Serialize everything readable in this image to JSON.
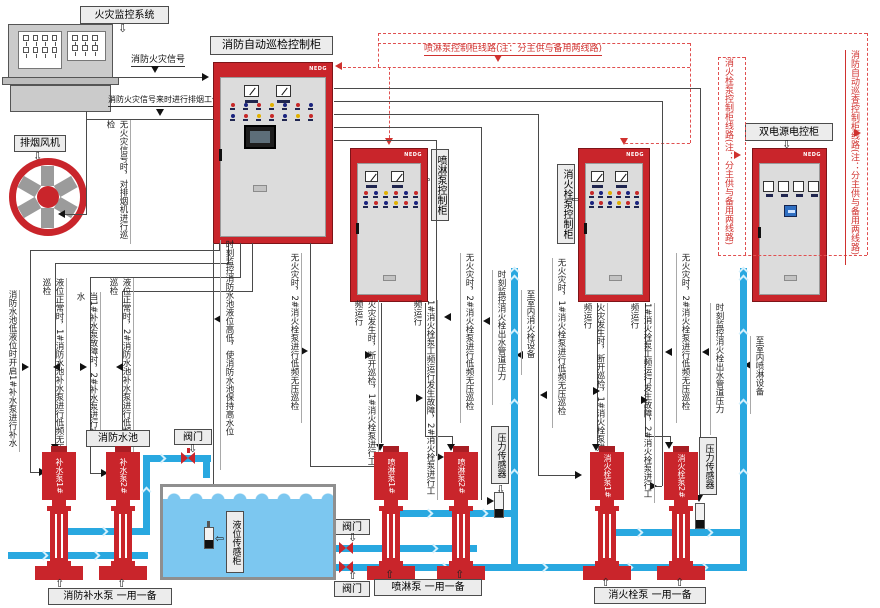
{
  "monitor": {
    "label": "火灾监控系统"
  },
  "fan": {
    "label": "排烟风机"
  },
  "signals": {
    "fire": "消防火灾信号",
    "smoke": "消防火灾信号来时进行排烟工作",
    "fan_note": "无火灾信号时，对排烟机进行巡检"
  },
  "cabinets": {
    "inspection": {
      "label": "消防自动巡检控制柜",
      "brand": "NEDG"
    },
    "spray": {
      "label": "喷淋泵控制柜",
      "brand": "NEDG"
    },
    "hydrant": {
      "label": "消火栓泵控制柜",
      "brand": "NEDG"
    },
    "dual_power": {
      "label": "双电源电控柜",
      "brand": "NEDG"
    }
  },
  "power_lines": {
    "spray": "喷淋泵控制柜线路(注：分主供与备用两线路)",
    "hydrant": "消火栓泵控制柜线路(注：分主供与备用两线路)",
    "inspection": "消防自动巡查控制柜线路(注：分主供与备用两线路)"
  },
  "tank": {
    "label": "消防水池",
    "level_sensor": "液位传感柜"
  },
  "valve_label": "阀门",
  "pressure_sensor_label": "压力传感器",
  "pumps": {
    "makeup1": "补水泵1#",
    "makeup2": "补水泵2#",
    "spray1": "喷淋泵1#",
    "spray2": "喷淋泵2#",
    "hydrant1": "消火栓泵1#",
    "hydrant2": "消火栓泵2#",
    "makeup_group": "消防补水泵  一用一备",
    "spray_group": "喷淋泵  一用一备",
    "hydrant_group": "消火栓泵  一用一备"
  },
  "annotations": {
    "a1": "消防水池低液位时开启1#补水泵进行补水",
    "a2": "液位正常时，1#消防水池补水泵进行低频无压巡检",
    "a3": "当1#补水泵故障时，2#补水泵进行补水",
    "a4": "液位正常时，2#消防水池补水泵进行低频无压巡检",
    "a5": "时刻监控消防水池液位高低，使消防水池保持高水位",
    "a6": "无火灾时，2#消火栓泵进行低频无压巡检",
    "a7": "火灾发生时，断开巡检，1#消火栓泵进行工频运行",
    "a8": "1#消火栓泵工频运行发生故障，2#消火栓泵进行工频运行",
    "a9": "无火灾时，2#消火栓泵进行低频无压巡检",
    "a10": "时刻监控消火栓出水管道压力",
    "a11": "至室内消火栓设备",
    "a12": "无火灾时，1#消火栓泵进行低频无压巡检",
    "a13": "火灾发生时，断开巡检，1#消火栓泵进行工频运行",
    "a14": "1#消火栓泵工频运行发生故障，2#消火栓泵进行工频运行",
    "a15": "无火灾时，2#消火栓泵进行低频无压巡检",
    "a16": "时刻监控消火栓出水管道压力",
    "a17": "至室内喷淋设备"
  },
  "colors": {
    "cabinet_red": "#c9252b",
    "pipe_blue": "#29a8e0",
    "water_blue": "#7cc7f0",
    "wire_gray": "#4a4a4a",
    "note_red": "#d0322f",
    "label_bg": "#ececec"
  }
}
